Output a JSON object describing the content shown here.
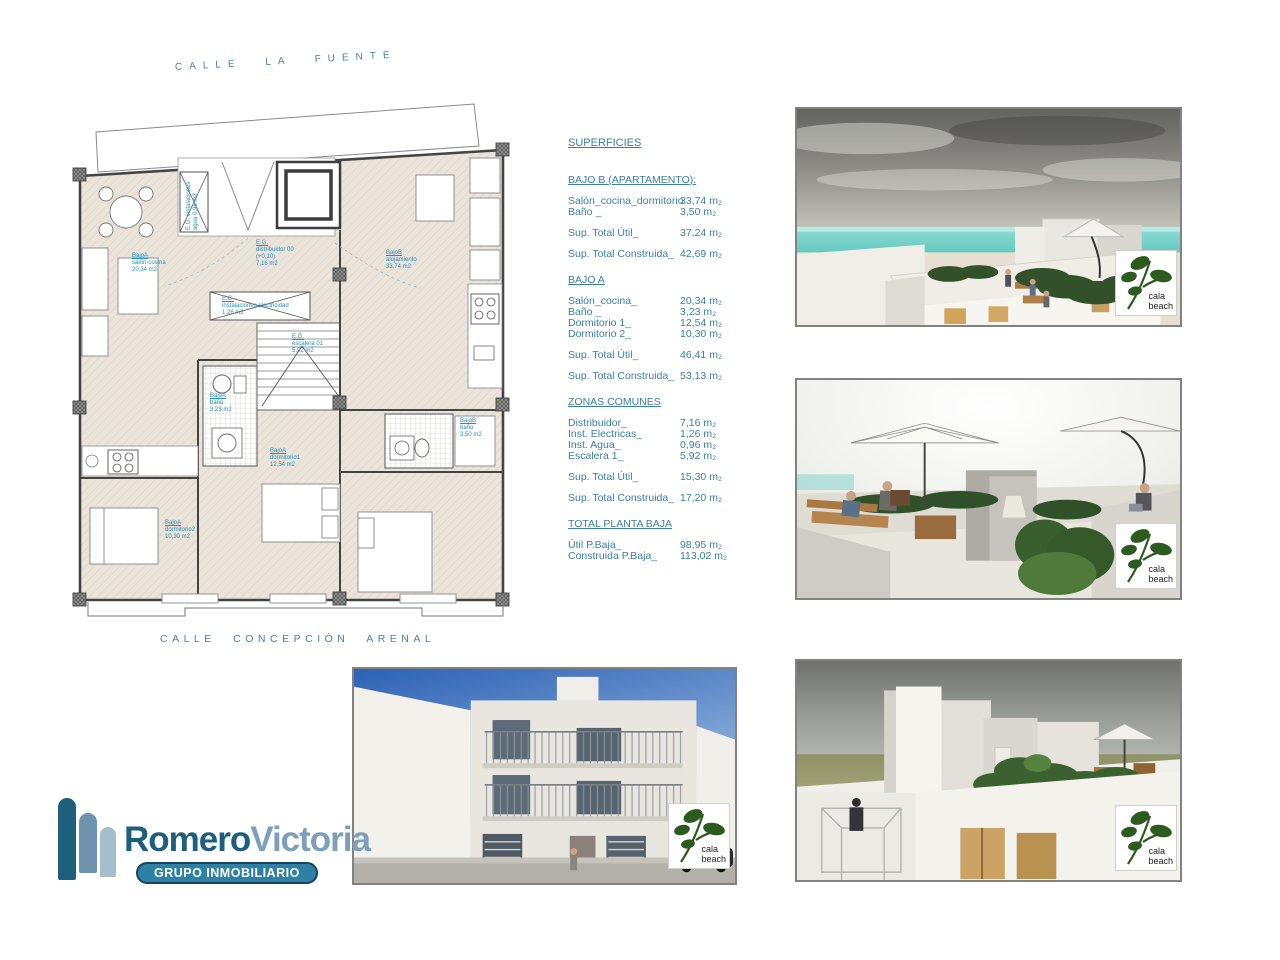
{
  "plan": {
    "street_top": "CALLE LA FUENTE",
    "street_bottom": "CALLE CONCEPCIÓN ARENAL",
    "labels": [
      {
        "l1": "BajoA",
        "l2": "salón-cocina",
        "l3": "20,34 m2",
        "l4": ""
      },
      {
        "l1": "E.G.",
        "l2": "distribuidor 00",
        "l3": "(+0,10)",
        "l4": "7,16 m2"
      },
      {
        "l1": "BajoB",
        "l2": "alojamiento",
        "l3": "33,74 m2",
        "l4": ""
      },
      {
        "l1": "E.G.",
        "l2": "instalaciones electricidad",
        "l3": "1,26 m2",
        "l4": ""
      },
      {
        "l1": "E.G.",
        "l2": "escalera 01",
        "l3": "5,92 m2",
        "l4": ""
      },
      {
        "l1": "BajoA",
        "l2": "baño",
        "l3": "3,23 m2",
        "l4": ""
      },
      {
        "l1": "BajoB",
        "l2": "baño",
        "l3": "3,50 m2",
        "l4": ""
      },
      {
        "l1": "BajoA",
        "l2": "dormitorio1",
        "l3": "12,54 m2",
        "l4": ""
      },
      {
        "l1": "BajoA",
        "l2": "dormitorio2",
        "l3": "10,30 m2",
        "l4": ""
      },
      {
        "l1": "E.G. instalaciones",
        "l2": "agua 0,96 m2",
        "l3": "",
        "l4": ""
      }
    ]
  },
  "superficies": {
    "title": "SUPERFICIES",
    "sections": [
      {
        "heading": "BAJO B (APARTAMENTO):",
        "rows": [
          {
            "label": "Salón_cocina_dormitorio",
            "value": "33,74 m₂"
          },
          {
            "label": "Baño _",
            "value": "3,50 m₂"
          }
        ],
        "totals": [
          {
            "label": "Sup. Total Útil_",
            "value": "37,24 m₂"
          },
          {
            "label": "Sup. Total Construida_",
            "value": "42,69 m₂"
          }
        ]
      },
      {
        "heading": "BAJO A",
        "rows": [
          {
            "label": "Salón_cocina_",
            "value": "20,34 m₂"
          },
          {
            "label": "Baño _",
            "value": "3,23 m₂"
          },
          {
            "label": "Dormitorio 1_",
            "value": "12,54 m₂"
          },
          {
            "label": "Dormitorio 2_",
            "value": "10,30 m₂"
          }
        ],
        "totals": [
          {
            "label": "Sup. Total Útil_",
            "value": "46,41 m₂"
          },
          {
            "label": "Sup. Total Construida_",
            "value": "53,13 m₂"
          }
        ]
      },
      {
        "heading": "ZONAS COMUNES",
        "rows": [
          {
            "label": "Distribuidor_",
            "value": "7,16 m₂"
          },
          {
            "label": "Inst. Electricas_",
            "value": "1,26 m₂"
          },
          {
            "label": "Inst. Agua_",
            "value": "0,96 m₂"
          },
          {
            "label": "Escalera 1_",
            "value": "5,92 m₂"
          }
        ],
        "totals": [
          {
            "label": "Sup. Total Útil_",
            "value": "15,30 m₂"
          },
          {
            "label": "Sup. Total Construida_",
            "value": "17,20 m₂"
          }
        ]
      },
      {
        "heading": "TOTAL PLANTA BAJA",
        "rows": [
          {
            "label": "Útil P.Baja_",
            "value": "98,95 m₂"
          },
          {
            "label": "Construida P.Baja_",
            "value": "113,02 m₂"
          }
        ],
        "totals": []
      }
    ]
  },
  "brand": {
    "primary": "Romero",
    "secondary": "Victoria",
    "tagline": "GRUPO INMOBILIARIO"
  },
  "watermark": {
    "line1": "cala",
    "line2": "beach"
  },
  "colors": {
    "table_text": "#3b7ea7",
    "plan_label_blue": "#1f8fbf",
    "brand_dark": "#1d5f7d",
    "brand_light": "#7da0ba",
    "pill_bg": "#2e81a5",
    "leaf_green": "#2d5a1e",
    "sea_turquoise": "#6fcdc4"
  }
}
